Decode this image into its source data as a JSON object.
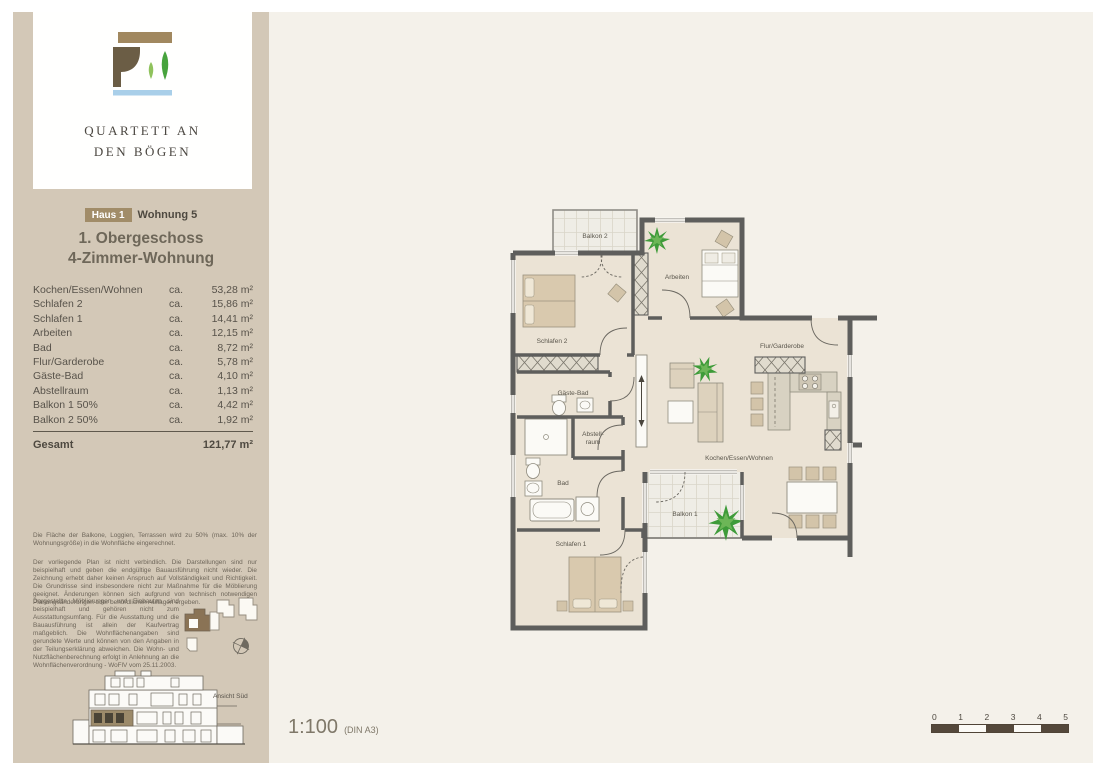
{
  "brand": {
    "line1": "QUARTETT AN",
    "line2": "DEN BÖGEN"
  },
  "header": {
    "badge": "Haus 1",
    "unit": "Wohnung 5",
    "floor": "1. Obergeschoss",
    "type": "4-Zimmer-Wohnung"
  },
  "area_table": {
    "ca_label": "ca.",
    "rows": [
      {
        "name": "Kochen/Essen/Wohnen",
        "area": "53,28 m²"
      },
      {
        "name": "Schlafen 2",
        "area": "15,86 m²"
      },
      {
        "name": "Schlafen 1",
        "area": "14,41 m²"
      },
      {
        "name": "Arbeiten",
        "area": "12,15 m²"
      },
      {
        "name": "Bad",
        "area": "8,72 m²"
      },
      {
        "name": "Flur/Garderobe",
        "area": "5,78 m²"
      },
      {
        "name": "Gäste-Bad",
        "area": "4,10 m²"
      },
      {
        "name": "Abstellraum",
        "area": "1,13 m²"
      },
      {
        "name": "Balkon 1 50%",
        "area": "4,42 m²"
      },
      {
        "name": "Balkon 2 50%",
        "area": "1,92 m²"
      }
    ],
    "total_label": "Gesamt",
    "total_value": "121,77 m²"
  },
  "legal": {
    "p1": "Die Fläche der Balkone, Loggien, Terrassen wird zu 50% (max. 10% der Wohnungsgröße) in die Wohnfläche eingerechnet.",
    "p2": "Der vorliegende Plan ist nicht verbindlich. Die Darstellungen sind nur beispielhaft und geben die endgültige Bauausführung nicht wieder. Die Zeichnung erhebt daher keinen Anspruch auf Vollständigkeit und Richtigkeit. Die Grundrisse sind insbesondere nicht zur Maßnahme für die Möblierung geeignet. Änderungen können sich aufgrund von technisch notwendigen Planungsänderungen oder behördlichen Auflagen ergeben.",
    "p3": "Dargestellte Möblierungen und Einbauten sind beispielhaft und gehören nicht zum Ausstattungsumfang. Für die Ausstattung und die Bauausführung ist allein der Kaufvertrag maßgeblich. Die Wohnflächenangaben sind gerundete Werte und können von den Angaben in der Teilungserklärung abweichen. Die Wohn- und Nutzflächenberechnung erfolgt in Anlehnung an die Wohnflächenverordnung - WoFlV vom 25.11.2003."
  },
  "elevation": {
    "caption": "Ansicht Süd"
  },
  "plan": {
    "labels": {
      "balkon2": "Balkon 2",
      "arbeiten": "Arbeiten",
      "schlafen2": "Schlafen 2",
      "flur": "Flur/Garderobe",
      "gaestebad": "Gäste-Bad",
      "abstell1": "Abstell-",
      "abstell2": "raum",
      "bad": "Bad",
      "schlafen1": "Schlafen 1",
      "balkon1": "Balkon 1",
      "wohnen": "Kochen/Essen/Wohnen"
    }
  },
  "footer": {
    "scale": "1:100",
    "format": "(DIN A3)",
    "ticks": [
      "0",
      "1",
      "2",
      "3",
      "4",
      "5"
    ]
  },
  "colors": {
    "sidebar": "#d3c8b7",
    "accent_brown": "#a18c68",
    "wall": "#5e5e5c",
    "floor": "#ebe3d5",
    "furniture_tan": "#d9c9ae",
    "leaf_green": "#47a33d",
    "sky_blue": "#a9cfe9",
    "scalebar_dark": "#54483b"
  }
}
